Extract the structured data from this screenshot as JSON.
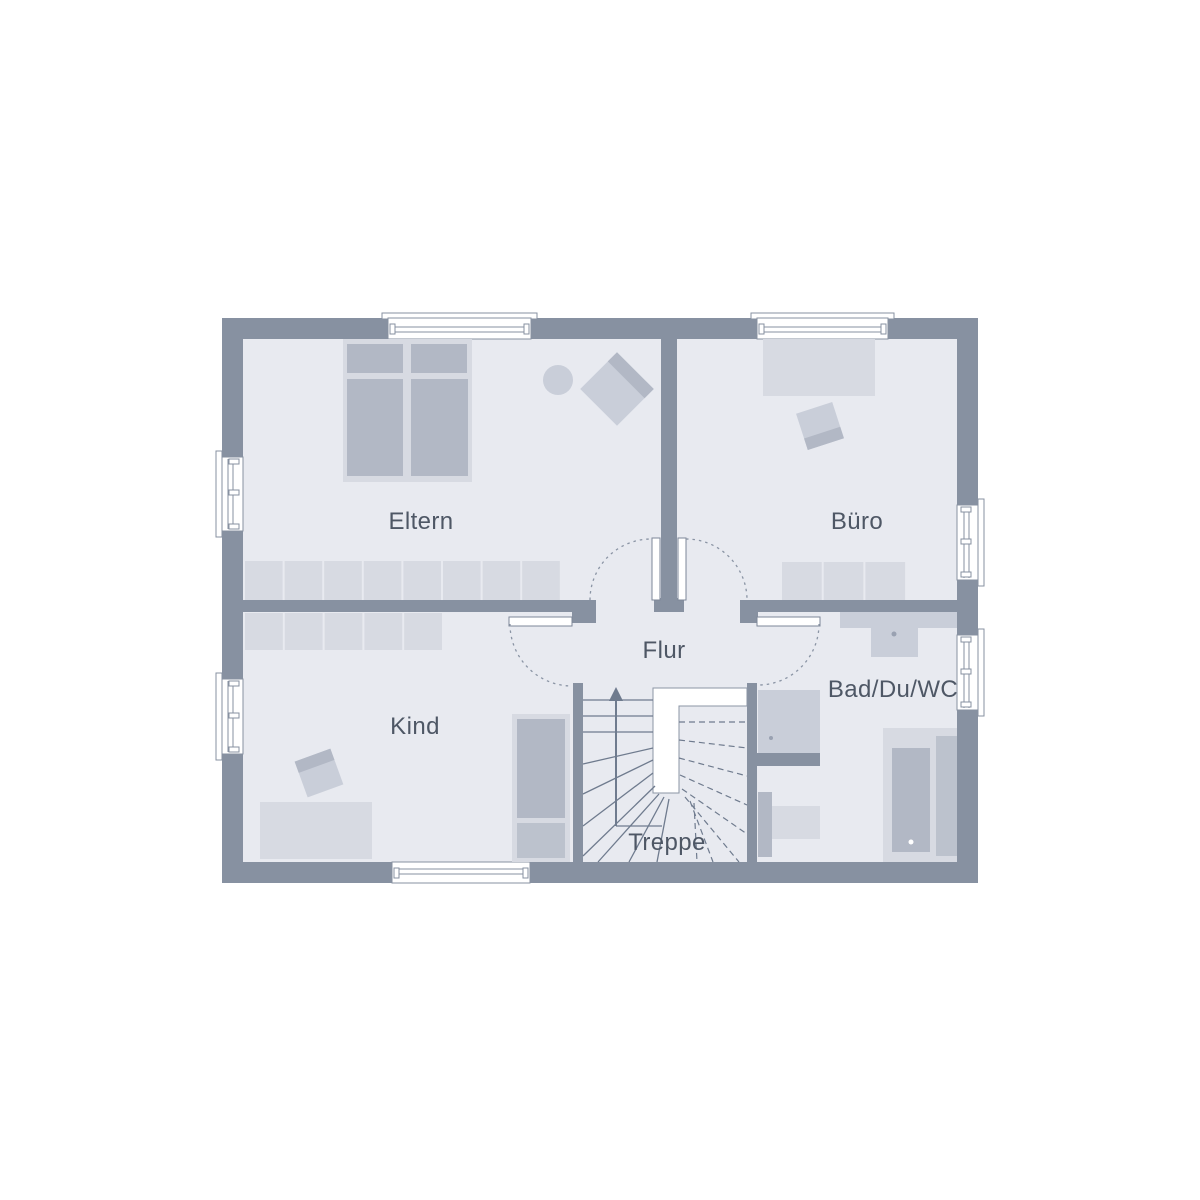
{
  "page": {
    "background": "#ffffff"
  },
  "plan": {
    "type": "floor-plan",
    "rooms": [
      {
        "id": "eltern",
        "label": "Eltern"
      },
      {
        "id": "buero",
        "label": "Büro"
      },
      {
        "id": "kind",
        "label": "Kind"
      },
      {
        "id": "flur",
        "label": "Flur"
      },
      {
        "id": "bad",
        "label": "Bad/Du/WC"
      },
      {
        "id": "treppe",
        "label": "Treppe"
      }
    ],
    "stairs": {
      "direction": "up"
    },
    "colors": {
      "wall": "#8791a1",
      "floor": "#e8eaf0",
      "furn-light": "#d7dae2",
      "furn-mid": "#c9ced9",
      "furn-dark": "#b2b8c5",
      "furn-dark2": "#bcc2cd",
      "line": "#6f7b8e",
      "dash": "#8a94a4",
      "text": "#4e5765"
    }
  }
}
